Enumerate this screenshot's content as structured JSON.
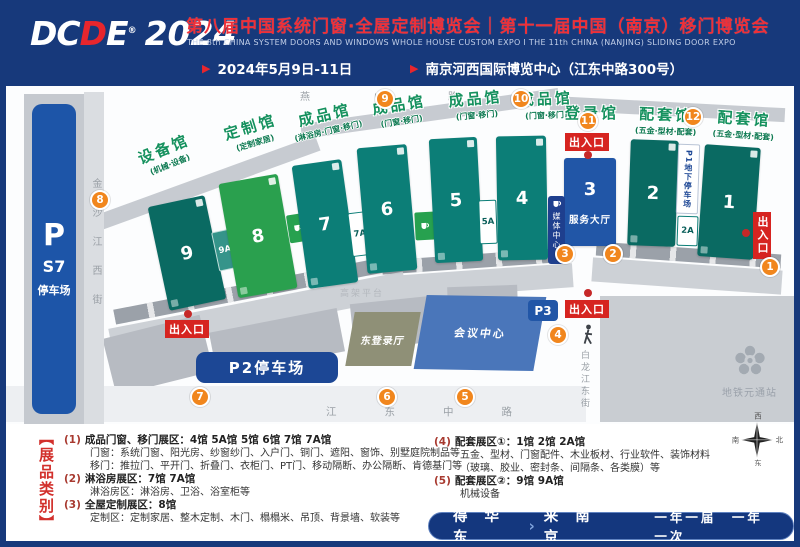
{
  "header": {
    "logo": {
      "d1": "D",
      "c": "C",
      "d2": "D",
      "e": "E",
      "reg": "®",
      "year": "2024"
    },
    "title": "第八届中国系统门窗·全屋定制博览会｜第十一届中国（南京）移门博览会",
    "subtitle": "THE 8th CHINA SYSTEM DOORS AND WINDOWS WHOLE HOUSE CUSTOM EXPO  I  THE 11th CHINA (NANJING) SLIDING DOOR EXPO",
    "date": "2024年5月9日-11日",
    "venue": "南京河西国际博览中心（江东中路300号）",
    "bullet": "▶"
  },
  "map": {
    "roads": {
      "west": "金沙江西街",
      "north": "燕山路",
      "south": "江东中路",
      "east": "白龙江东街",
      "platform": "高架平台"
    },
    "parking_s7": {
      "p": "P",
      "code": "S7",
      "label": "停车场"
    },
    "pavilions": [
      {
        "label": "设备馆",
        "sub": "(机械·设备)"
      },
      {
        "label": "定制馆",
        "sub": "(定制家居)"
      },
      {
        "label": "成品馆",
        "sub": "(淋浴房·门窗·移门)"
      },
      {
        "label": "成品馆",
        "sub": "(门窗·移门)"
      },
      {
        "label": "成品馆",
        "sub": "(门窗·移门)"
      },
      {
        "label": "成品馆",
        "sub": "(门窗·移门)"
      },
      {
        "label": "登录馆",
        "sub": ""
      },
      {
        "label": "配套馆",
        "sub": "(五金·型材·配套)"
      },
      {
        "label": "配套馆",
        "sub": "(五金·型材·配套)"
      }
    ],
    "halls": {
      "h9": "9",
      "h9a": "9A",
      "h8": "8",
      "h7": "7",
      "h7a": "7A",
      "h6": "6",
      "h5": "5",
      "h5a": "5A",
      "h4": "4",
      "h3": "3",
      "h2": "2",
      "h2a": "2A",
      "h1": "1"
    },
    "hall3_sub": "服务大厅",
    "media_center": "媒体中心",
    "p1": "P1地下停车场",
    "p2": "P2停车场",
    "p3": "P3",
    "conference": "会议中心",
    "east_login": "东登录厅",
    "entrance": "出入口",
    "metro": "地铁元通站",
    "gates": [
      "1",
      "2",
      "3",
      "4",
      "5",
      "6",
      "7",
      "8",
      "9",
      "10",
      "11",
      "12"
    ]
  },
  "legend": {
    "side": "【展品类别】",
    "items": [
      {
        "num": "(1)",
        "title": "成品门窗、移门展区：4馆 5A馆 5馆 6馆 7馆 7A馆",
        "lines": [
          "门窗：系统门窗、阳光房、纱窗纱门、入户门、铜门、遮阳、窗饰、别墅庭院制品等",
          "移门：推拉门、平开门、折叠门、衣柜门、PT门、移动隔断、办公隔断、肯德基门等"
        ]
      },
      {
        "num": "(2)",
        "title": "淋浴房展区：7馆 7A馆",
        "lines": [
          "淋浴房区：淋浴房、卫浴、浴室柜等"
        ]
      },
      {
        "num": "(3)",
        "title": "全屋定制展区：8馆",
        "lines": [
          "定制区：定制家居、整木定制、木门、榻榻米、吊顶、背景墙、软装等"
        ]
      },
      {
        "num": "(4)",
        "title": "配套展区①：1馆 2馆 2A馆",
        "lines": [
          "五金、型材、门窗配件、木业板材、行业软件、装饰材料",
          "（玻璃、胶业、密封条、间隔条、各类膜）等"
        ]
      },
      {
        "num": "(5)",
        "title": "配套展区②：9馆 9A馆",
        "lines": [
          "机械设备"
        ]
      }
    ],
    "compass": {
      "n": "北",
      "e": "东",
      "s": "南",
      "w": "西"
    }
  },
  "footer": {
    "left": "得 华 东",
    "sep": "›",
    "right": "来 南 京",
    "tail": "一年一届　一年一次"
  },
  "colors": {
    "navy": "#17397b",
    "red": "#ef3038",
    "teal": "#0c7e77",
    "green": "#2aa04e",
    "orange": "#f1861d"
  }
}
